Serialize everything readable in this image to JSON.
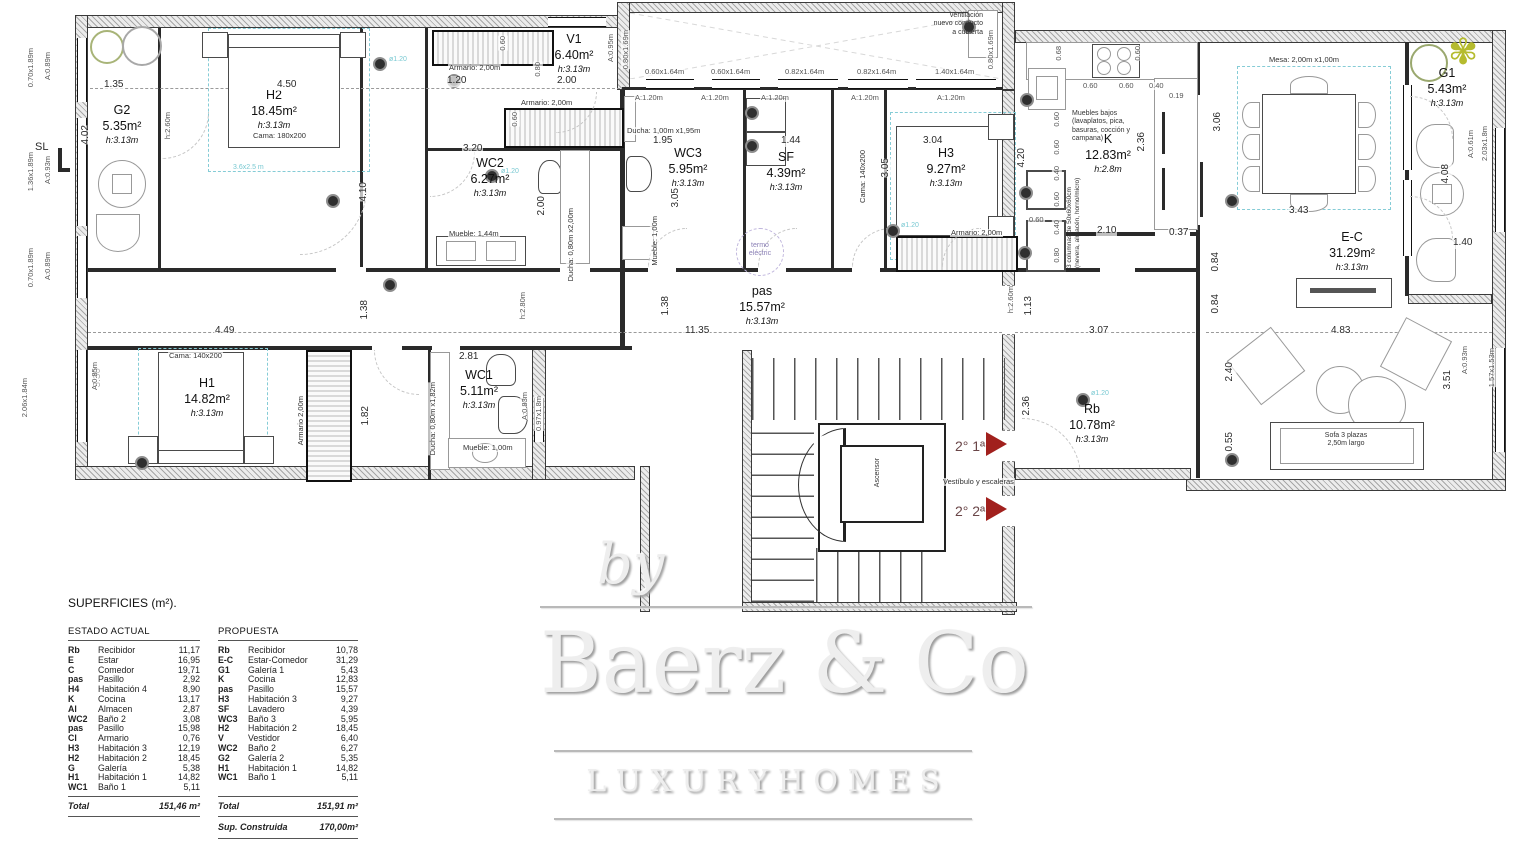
{
  "plan": {
    "rooms": [
      {
        "name": "G2",
        "area": "5.35m²",
        "height": "h:3.13m",
        "x": 90,
        "y": 103,
        "w": 64
      },
      {
        "name": "H2",
        "area": "18.45m²",
        "height": "h:3.13m",
        "x": 222,
        "y": 88,
        "w": 104
      },
      {
        "name": "V1",
        "area": "6.40m²",
        "height": "h:3.13m",
        "x": 538,
        "y": 32,
        "w": 72
      },
      {
        "name": "WC2",
        "area": "6.27m²",
        "height": "h:3.13m",
        "x": 452,
        "y": 156,
        "w": 76
      },
      {
        "name": "WC3",
        "area": "5.95m²",
        "height": "h:3.13m",
        "x": 650,
        "y": 146,
        "w": 76
      },
      {
        "name": "SF",
        "area": "4.39m²",
        "height": "h:3.13m",
        "x": 750,
        "y": 150,
        "w": 72
      },
      {
        "name": "H3",
        "area": "9.27m²",
        "height": "h:3.13m",
        "x": 908,
        "y": 146,
        "w": 76
      },
      {
        "name": "K",
        "area": "12.83m²",
        "height": "h:2.8m",
        "x": 1078,
        "y": 132,
        "w": 60
      },
      {
        "name": "G1",
        "area": "5.43m²",
        "height": "h:3.13m",
        "x": 1414,
        "y": 66,
        "w": 66
      },
      {
        "name": "E-C",
        "area": "31.29m²",
        "height": "h:3.13m",
        "x": 1310,
        "y": 230,
        "w": 84
      },
      {
        "name": "pas",
        "area": "15.57m²",
        "height": "h:3.13m",
        "x": 722,
        "y": 284,
        "w": 80
      },
      {
        "name": "Rb",
        "area": "10.78m²",
        "height": "h:3.13m",
        "x": 1054,
        "y": 402,
        "w": 76
      },
      {
        "name": "H1",
        "area": "14.82m²",
        "height": "h:3.13m",
        "x": 160,
        "y": 376,
        "w": 94
      },
      {
        "name": "WC1",
        "area": "5.11m²",
        "height": "h:3.13m",
        "x": 440,
        "y": 368,
        "w": 78
      }
    ],
    "dims": [
      {
        "t": "1.35",
        "x": 103,
        "y": 80
      },
      {
        "t": "4.50",
        "x": 276,
        "y": 80
      },
      {
        "t": "4.02",
        "x": 80,
        "y": 125,
        "v": 1
      },
      {
        "t": "4.10",
        "x": 358,
        "y": 182,
        "v": 1
      },
      {
        "t": "h:2.60m",
        "x": 163,
        "y": 112,
        "v": 1,
        "k": "win"
      },
      {
        "t": "1.20",
        "x": 446,
        "y": 76
      },
      {
        "t": "2.00",
        "x": 556,
        "y": 76
      },
      {
        "t": "0.80",
        "x": 533,
        "y": 62,
        "v": 1,
        "k": "win"
      },
      {
        "t": "0.60",
        "x": 498,
        "y": 36,
        "v": 1,
        "k": "win"
      },
      {
        "t": "0.60",
        "x": 510,
        "y": 112,
        "v": 1,
        "k": "win"
      },
      {
        "t": "3.20",
        "x": 462,
        "y": 144
      },
      {
        "t": "2.00",
        "x": 536,
        "y": 196,
        "v": 1
      },
      {
        "t": "1.95",
        "x": 652,
        "y": 136
      },
      {
        "t": "3.05",
        "x": 670,
        "y": 188,
        "v": 1
      },
      {
        "t": "1.44",
        "x": 780,
        "y": 136
      },
      {
        "t": "3.04",
        "x": 922,
        "y": 136
      },
      {
        "t": "3.05",
        "x": 880,
        "y": 158,
        "v": 1
      },
      {
        "t": "11.35",
        "x": 684,
        "y": 326
      },
      {
        "t": "1.38",
        "x": 359,
        "y": 300,
        "v": 1
      },
      {
        "t": "1.38",
        "x": 660,
        "y": 296,
        "v": 1
      },
      {
        "t": "4.49",
        "x": 214,
        "y": 326
      },
      {
        "t": "3.30",
        "x": 92,
        "y": 368,
        "v": 1
      },
      {
        "t": "1.82",
        "x": 360,
        "y": 406,
        "v": 1
      },
      {
        "t": "2.81",
        "x": 458,
        "y": 352
      },
      {
        "t": "h:2.80m",
        "x": 518,
        "y": 292,
        "v": 1,
        "k": "win"
      },
      {
        "t": "1.13",
        "x": 1023,
        "y": 296,
        "v": 1
      },
      {
        "t": "h:2.60m",
        "x": 1006,
        "y": 286,
        "v": 1,
        "k": "win"
      },
      {
        "t": "2.36",
        "x": 1021,
        "y": 396,
        "v": 1
      },
      {
        "t": "3.07",
        "x": 1088,
        "y": 326
      },
      {
        "t": "0.84",
        "x": 1210,
        "y": 252,
        "v": 1
      },
      {
        "t": "0.84",
        "x": 1210,
        "y": 294,
        "v": 1
      },
      {
        "t": "3.06",
        "x": 1212,
        "y": 112,
        "v": 1
      },
      {
        "t": "2.40",
        "x": 1224,
        "y": 362,
        "v": 1
      },
      {
        "t": "0.55",
        "x": 1224,
        "y": 432,
        "v": 1
      },
      {
        "t": "4.83",
        "x": 1330,
        "y": 326
      },
      {
        "t": "3.43",
        "x": 1288,
        "y": 206
      },
      {
        "t": "3.51",
        "x": 1442,
        "y": 370,
        "v": 1
      },
      {
        "t": "4.08",
        "x": 1440,
        "y": 164,
        "v": 1
      },
      {
        "t": "1.40",
        "x": 1452,
        "y": 238
      },
      {
        "t": "0.68",
        "x": 1054,
        "y": 46,
        "v": 1,
        "k": "win"
      },
      {
        "t": "0.60",
        "x": 1082,
        "y": 82,
        "k": "win"
      },
      {
        "t": "0.60",
        "x": 1118,
        "y": 82,
        "k": "win"
      },
      {
        "t": "0.40",
        "x": 1148,
        "y": 82,
        "k": "win"
      },
      {
        "t": "0.19",
        "x": 1168,
        "y": 92,
        "k": "win"
      },
      {
        "t": "0.60",
        "x": 1133,
        "y": 46,
        "v": 1,
        "k": "win"
      },
      {
        "t": "4.20",
        "x": 1016,
        "y": 148,
        "v": 1
      },
      {
        "t": "0.60",
        "x": 1052,
        "y": 112,
        "v": 1,
        "k": "win"
      },
      {
        "t": "0.60",
        "x": 1052,
        "y": 140,
        "v": 1,
        "k": "win"
      },
      {
        "t": "0.40",
        "x": 1052,
        "y": 166,
        "v": 1,
        "k": "win"
      },
      {
        "t": "0.60",
        "x": 1052,
        "y": 192,
        "v": 1,
        "k": "win"
      },
      {
        "t": "0.40",
        "x": 1052,
        "y": 220,
        "v": 1,
        "k": "win"
      },
      {
        "t": "0.80",
        "x": 1052,
        "y": 248,
        "v": 1,
        "k": "win"
      },
      {
        "t": "0.60",
        "x": 1028,
        "y": 216,
        "k": "win"
      },
      {
        "t": "2.36",
        "x": 1136,
        "y": 132,
        "v": 1
      },
      {
        "t": "2.10",
        "x": 1096,
        "y": 226
      },
      {
        "t": "0.37",
        "x": 1168,
        "y": 228
      }
    ],
    "openings": [
      {
        "t": "0.70x1.89m",
        "x": 26,
        "y": 48,
        "v": 1
      },
      {
        "t": "A:0.89m",
        "x": 43,
        "y": 52,
        "v": 1
      },
      {
        "t": "1.36x1.89m",
        "x": 26,
        "y": 152,
        "v": 1
      },
      {
        "t": "A:0.93m",
        "x": 43,
        "y": 156,
        "v": 1
      },
      {
        "t": "0.70x1.89m",
        "x": 26,
        "y": 248,
        "v": 1
      },
      {
        "t": "A:0.89m",
        "x": 43,
        "y": 252,
        "v": 1
      },
      {
        "t": "2.06x1.84m",
        "x": 20,
        "y": 378,
        "v": 1
      },
      {
        "t": "A:0.85m",
        "x": 90,
        "y": 362,
        "v": 1
      },
      {
        "t": "A:0.95m",
        "x": 606,
        "y": 34,
        "v": 1
      },
      {
        "t": "0.80x1.69m",
        "x": 621,
        "y": 30,
        "v": 1
      },
      {
        "t": "0.60x1.64m",
        "x": 644,
        "y": 68
      },
      {
        "t": "0.60x1.64m",
        "x": 710,
        "y": 68
      },
      {
        "t": "0.82x1.64m",
        "x": 784,
        "y": 68
      },
      {
        "t": "0.82x1.64m",
        "x": 856,
        "y": 68
      },
      {
        "t": "1.40x1.64m",
        "x": 934,
        "y": 68
      },
      {
        "t": "0.80x1.69m",
        "x": 986,
        "y": 30,
        "v": 1
      },
      {
        "t": "A:1.20m",
        "x": 634,
        "y": 94
      },
      {
        "t": "A:1.20m",
        "x": 700,
        "y": 94
      },
      {
        "t": "A:1.20m",
        "x": 760,
        "y": 94
      },
      {
        "t": "A:1.20m",
        "x": 850,
        "y": 94
      },
      {
        "t": "A:1.20m",
        "x": 936,
        "y": 94
      },
      {
        "t": "A:0.61m",
        "x": 1466,
        "y": 130,
        "v": 1
      },
      {
        "t": "2.03x1.8m",
        "x": 1480,
        "y": 126,
        "v": 1
      },
      {
        "t": "A:0.93m",
        "x": 1460,
        "y": 346,
        "v": 1
      },
      {
        "t": "1.57x1.53m",
        "x": 1487,
        "y": 348,
        "v": 1
      },
      {
        "t": "0.97x1.8m",
        "x": 534,
        "y": 396,
        "v": 1
      },
      {
        "t": "A:0.83m",
        "x": 520,
        "y": 392,
        "v": 1
      }
    ],
    "furniture_notes": [
      {
        "t": "Armario: 2,00m",
        "x": 448,
        "y": 64
      },
      {
        "t": "Armario: 2,00m",
        "x": 520,
        "y": 99
      },
      {
        "t": "Armario: 2,00m",
        "x": 950,
        "y": 229
      },
      {
        "t": "Armario 2,00m",
        "x": 296,
        "y": 396,
        "v": 1
      },
      {
        "t": "Mueble: 1,44m",
        "x": 448,
        "y": 230
      },
      {
        "t": "Mueble: 1,00m",
        "x": 650,
        "y": 216,
        "v": 1
      },
      {
        "t": "Mueble: 1,00m",
        "x": 462,
        "y": 444
      },
      {
        "t": "Ducha: 1,00m x1,95m",
        "x": 626,
        "y": 127
      },
      {
        "t": "Ducha: 0,80m x2,00m",
        "x": 566,
        "y": 208,
        "v": 1
      },
      {
        "t": "Ducha: 0,80m x1,82m",
        "x": 428,
        "y": 382,
        "v": 1
      },
      {
        "t": "Cama: 180x200",
        "x": 252,
        "y": 132
      },
      {
        "t": "Cama: 140x200",
        "x": 858,
        "y": 150,
        "v": 1
      },
      {
        "t": "Cama: 140x200",
        "x": 168,
        "y": 352
      },
      {
        "t": "Mesa: 2,00m x1,00m",
        "x": 1268,
        "y": 56
      },
      {
        "t": "Vestíbulo y escaleras",
        "x": 942,
        "y": 478
      }
    ],
    "cyan_tags": [
      {
        "t": "3.6x2.5 m",
        "x": 232,
        "y": 164
      },
      {
        "t": "ø1.20",
        "x": 388,
        "y": 56
      },
      {
        "t": "ø1.20",
        "x": 500,
        "y": 168
      },
      {
        "t": "ø1.20",
        "x": 900,
        "y": 222
      },
      {
        "t": "ø1.20",
        "x": 1090,
        "y": 390
      }
    ],
    "dots": [
      {
        "x": 373,
        "y": 57
      },
      {
        "x": 326,
        "y": 194
      },
      {
        "x": 447,
        "y": 74
      },
      {
        "x": 485,
        "y": 169
      },
      {
        "x": 745,
        "y": 106
      },
      {
        "x": 745,
        "y": 139
      },
      {
        "x": 886,
        "y": 224
      },
      {
        "x": 383,
        "y": 278
      },
      {
        "x": 1076,
        "y": 393
      },
      {
        "x": 1225,
        "y": 453
      },
      {
        "x": 1225,
        "y": 194
      },
      {
        "x": 1019,
        "y": 186
      },
      {
        "x": 1018,
        "y": 246
      },
      {
        "x": 1020,
        "y": 93
      },
      {
        "x": 135,
        "y": 456
      },
      {
        "x": 962,
        "y": 20
      }
    ],
    "annotations": {
      "ventilacion": "ventilación\nnuevo conducto\na cubierta",
      "termo": "termo\neléctric",
      "ascensor": "Ascensor",
      "floor1": "2° 1ª",
      "floor2": "2° 2ª",
      "sl": "SL",
      "muebles_bajos": "Muebles bajos\n(lavaplatos, pica,\nbasuras, cocción y\ncampana)",
      "columnas": "3 columnas de 50x60x60cm\n(nevera, almacén, horno/micro)",
      "sofa": "Sofa 3 plazas\n2,50m largo"
    }
  },
  "summary_table": {
    "title": "SUPERFICIES (m²).",
    "estado": {
      "header": "ESTADO ACTUAL",
      "rows": [
        [
          "Rb",
          "Recibidor",
          "11,17"
        ],
        [
          "E",
          "Estar",
          "16,95"
        ],
        [
          "C",
          "Comedor",
          "19,71"
        ],
        [
          "pas",
          "Pasillo",
          "2,92"
        ],
        [
          "H4",
          "Habitación 4",
          "8,90"
        ],
        [
          "K",
          "Cocina",
          "13,17"
        ],
        [
          "Al",
          "Almacen",
          "2,87"
        ],
        [
          "WC2",
          "Baño 2",
          "3,08"
        ],
        [
          "pas",
          "Pasillo",
          "15,98"
        ],
        [
          "Cl",
          "Armario",
          "0,76"
        ],
        [
          "H3",
          "Habitación 3",
          "12,19"
        ],
        [
          "H2",
          "Habitación 2",
          "18,45"
        ],
        [
          "G",
          "Galería",
          "5,38"
        ],
        [
          "H1",
          "Habitación 1",
          "14,82"
        ],
        [
          "WC1",
          "Baño 1",
          "5,11"
        ]
      ],
      "total_label": "Total",
      "total": "151,46 m²"
    },
    "propuesta": {
      "header": "PROPUESTA",
      "rows": [
        [
          "Rb",
          "Recibidor",
          "10,78"
        ],
        [
          "E-C",
          "Estar-Comedor",
          "31,29"
        ],
        [
          "G1",
          "Galería 1",
          "5,43"
        ],
        [
          "K",
          "Cocina",
          "12,83"
        ],
        [
          "pas",
          "Pasillo",
          "15,57"
        ],
        [
          "H3",
          "Habitación 3",
          "9,27"
        ],
        [
          "SF",
          "Lavadero",
          "4,39"
        ],
        [
          "WC3",
          "Baño 3",
          "5,95"
        ],
        [
          "H2",
          "Habitación 2",
          "18,45"
        ],
        [
          "V",
          "Vestidor",
          "6,40"
        ],
        [
          "WC2",
          "Baño 2",
          "6,27"
        ],
        [
          "G2",
          "Galería 2",
          "5,35"
        ],
        [
          "H1",
          "Habitación 1",
          "14,82"
        ],
        [
          "WC1",
          "Baño 1",
          "5,11"
        ]
      ],
      "total_label": "Total",
      "total": "151,91 m²",
      "sup_label": "Sup. Construida",
      "sup": "170,00m²"
    }
  },
  "watermark": {
    "by": "by",
    "brand": "Baerz & Co",
    "tagline": "L U X U R Y   H O M E S"
  }
}
